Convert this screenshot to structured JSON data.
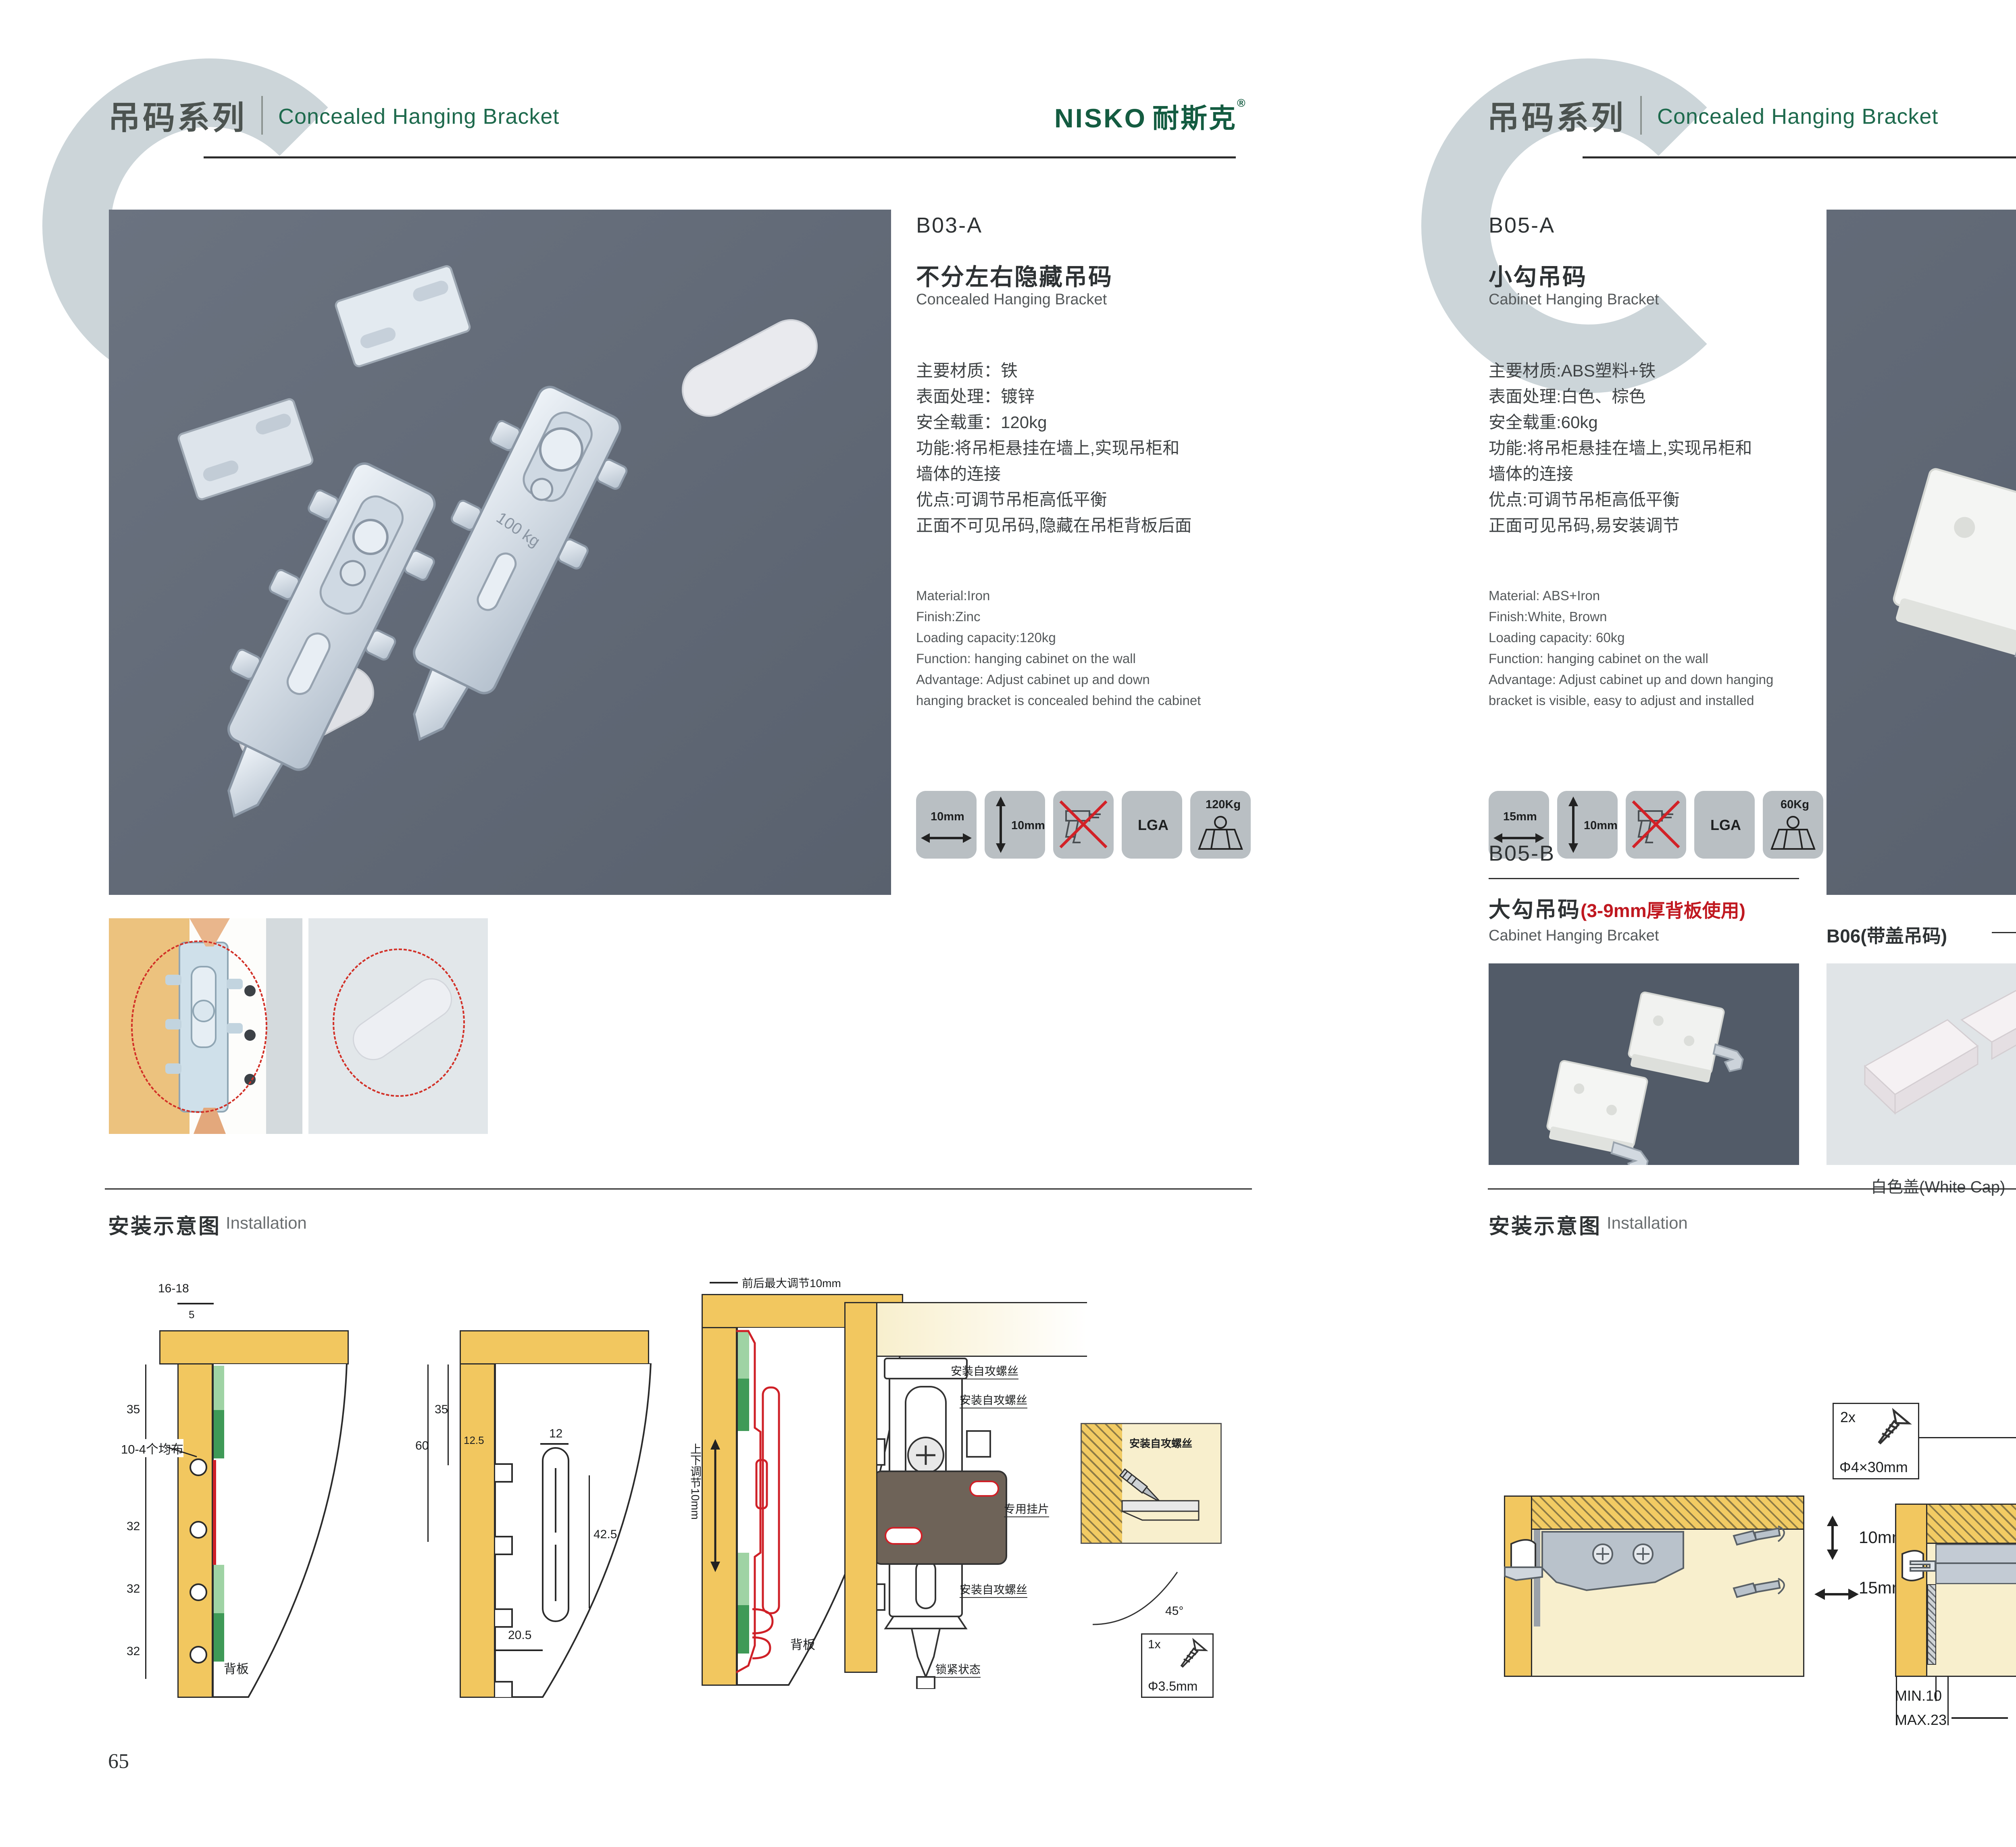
{
  "header": {
    "series_cn": "吊码系列",
    "series_en": "Concealed Hanging Bracket"
  },
  "brand": {
    "name": "NISKO",
    "name_cn": "耐斯克",
    "reg": "®"
  },
  "left": {
    "product": {
      "model": "B03-A",
      "title_cn": "不分左右隐藏吊码",
      "title_en": "Concealed Hanging Bracket",
      "specs_cn": [
        "主要材质：铁",
        "表面处理：镀锌",
        "安全载重：120kg",
        "功能:将吊柜悬挂在墙上,实现吊柜和",
        "墙体的连接",
        "优点:可调节吊柜高低平衡",
        "正面不可见吊码,隐藏在吊柜背板后面"
      ],
      "specs_en": [
        "Material:Iron",
        "Finish:Zinc",
        "Loading capacity:120kg",
        "Function: hanging cabinet on the wall",
        "Advantage: Adjust cabinet up and down",
        "hanging bracket is concealed behind the cabinet"
      ],
      "badges": [
        {
          "label": "10mm"
        },
        {
          "label": "10mm"
        },
        {
          "label": ""
        },
        {
          "label": "LGA"
        },
        {
          "label": "120Kg"
        }
      ]
    },
    "installation": {
      "title_cn": "安装示意图",
      "title_en": "Installation",
      "p1": {
        "dims": [
          "16-18",
          "5",
          "35",
          "32",
          "32",
          "32"
        ],
        "note": "10-4个均布",
        "backboard": "背板"
      },
      "p2": {
        "dims": [
          "60",
          "35",
          "12.5",
          "12",
          "42.5",
          "20.5"
        ]
      },
      "p3": {
        "top_note": "前后最大调节10mm",
        "side_note": "上下调节10mm",
        "backboard": "背板"
      },
      "p4": {
        "callouts": [
          "安装自攻螺丝",
          "安装自攻螺丝",
          "专用挂片",
          "安装自攻螺丝",
          "锁紧状态"
        ],
        "detail_label": "安装自攻螺丝",
        "angle": "45°",
        "screw_qty": "1x",
        "screw_dia": "Φ3.5mm"
      }
    },
    "page_number": "65"
  },
  "right": {
    "product_a": {
      "model": "B05-A",
      "title_cn": "小勾吊码",
      "title_en": "Cabinet Hanging Bracket",
      "specs_cn": [
        "主要材质:ABS塑料+铁",
        "表面处理:白色、棕色",
        "安全载重:60kg",
        "功能:将吊柜悬挂在墙上,实现吊柜和",
        "墙体的连接",
        "优点:可调节吊柜高低平衡",
        "正面可见吊码,易安装调节"
      ],
      "specs_en": [
        "Material: ABS+Iron",
        "Finish:White, Brown",
        "Loading capacity: 60kg",
        "Function: hanging cabinet on the wall",
        "Advantage: Adjust cabinet up and down hanging",
        "bracket is visible, easy to adjust and installed"
      ],
      "badges": [
        {
          "label": "15mm"
        },
        {
          "label": "10mm"
        },
        {
          "label": ""
        },
        {
          "label": "LGA"
        },
        {
          "label": "60Kg"
        }
      ]
    },
    "product_b": {
      "model": "B05-B",
      "title_cn": "大勾吊码",
      "title_note": "(3-9mm厚背板使用)",
      "title_en": "Cabinet Hanging Brcaket"
    },
    "b06": {
      "label": "B06(带盖吊码)",
      "caps": [
        {
          "caption": "白色盖(White Cap)"
        },
        {
          "caption": "灰色盖(Gray Cap)"
        },
        {
          "caption": "银色盖(Silver Cap)"
        }
      ]
    },
    "installation": {
      "title_cn": "安装示意图",
      "title_en": "Installation",
      "p1": {
        "dims": [
          "10mm",
          "15mm"
        ]
      },
      "screw_box": {
        "qty": "2x",
        "size": "Φ4×30mm"
      },
      "p2": {
        "dims": [
          "18",
          "MIN.10",
          "MAX.23",
          "58"
        ]
      },
      "p3": {
        "dims": [
          "16",
          "42",
          "RMAX4",
          "16",
          "17",
          "32"
        ]
      }
    },
    "page_number": "66"
  }
}
